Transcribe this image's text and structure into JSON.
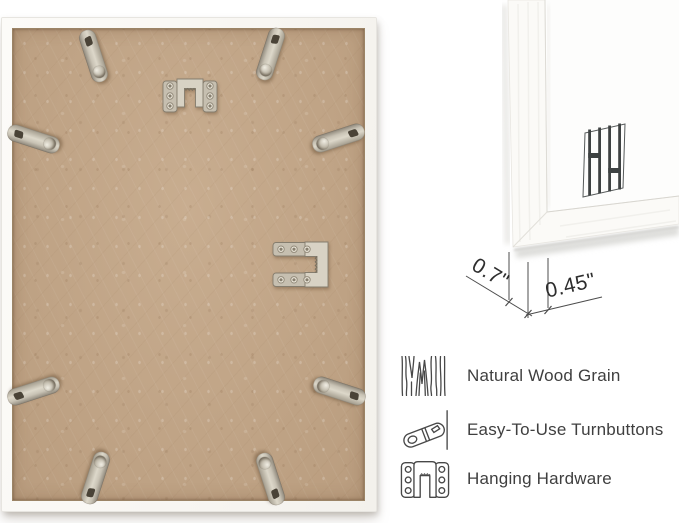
{
  "scene": {
    "background": "#ffffff"
  },
  "frame_back": {
    "description": "back of white picture frame with MDF backing board",
    "backing_color": "#c2a586",
    "frame_color": "#faf8f4",
    "metal_color": "#c9c3b5",
    "turnbutton_count": 8,
    "hanger_count": 2
  },
  "corner_detail": {
    "description": "front corner close-up of white frame moulding",
    "depth_label": "0.7\"",
    "face_label": "0.45\"",
    "logo": "hh-monogram"
  },
  "features": [
    {
      "icon": "wood-grain-icon",
      "label": "Natural Wood Grain"
    },
    {
      "icon": "turnbutton-icon",
      "label": "Easy-To-Use Turnbuttons"
    },
    {
      "icon": "hanging-hardware-icon",
      "label": "Hanging Hardware"
    }
  ]
}
